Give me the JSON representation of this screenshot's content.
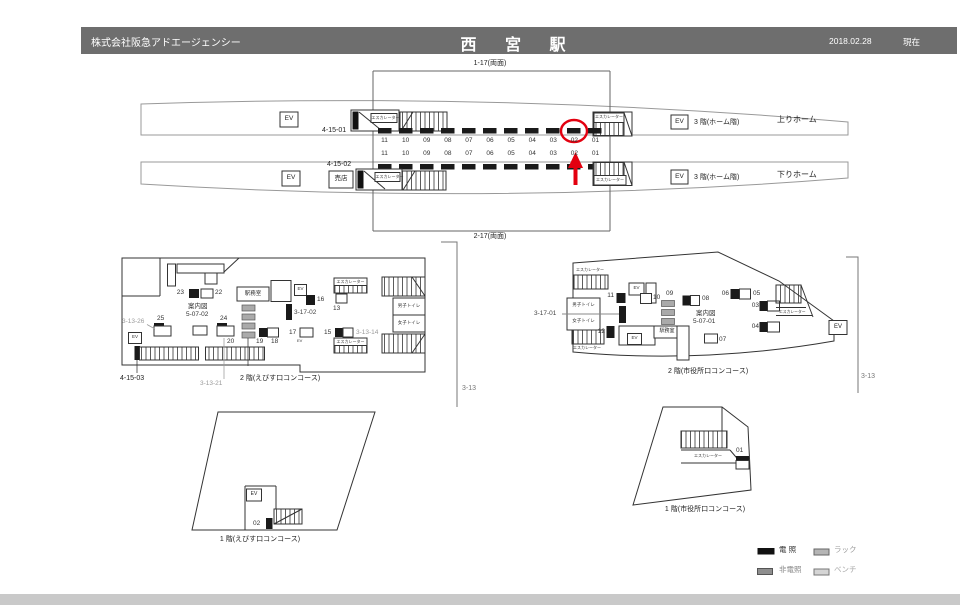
{
  "header": {
    "company": "株式会社阪急アドエージェンシー",
    "station": "西 宮 駅",
    "date": "2018.02.28",
    "as_of": "現在"
  },
  "labels": {
    "ev": "EV",
    "escalator": "エスカレーター"
  },
  "platforms": {
    "bracket_top": "1-17(両面)",
    "bracket_bottom": "2-17(両面)",
    "numbers": [
      "11",
      "10",
      "09",
      "08",
      "07",
      "06",
      "05",
      "04",
      "03",
      "02",
      "01"
    ],
    "up": {
      "esc_id": "4-15-01",
      "floor": "3 階(ホーム階)",
      "name": "上りホーム"
    },
    "down": {
      "esc_id": "4-15-02",
      "shop": "売店",
      "floor": "3 階(ホーム階)",
      "name": "下りホーム"
    }
  },
  "ebisu2f": {
    "title": "2 階(えびす口コンコース)",
    "office": "駅務室",
    "map": "案内図",
    "map_id": "5-07-02",
    "men": "男子トイレ",
    "women": "女子トイレ",
    "side": "3-13",
    "pos": {
      "13": "13",
      "15": "15",
      "16": "16",
      "17": "17",
      "18": "18",
      "19": "19",
      "20": "20",
      "22": "22",
      "23": "23",
      "24": "24",
      "25": "25"
    },
    "refs": {
      "r3_13_26": "3-13-26",
      "r3_13_21": "3-13-21",
      "r4_15_03": "4-15-03",
      "r3_17_02": "3-17-02",
      "r3_13_14": "3-13-14"
    }
  },
  "ebisu1f": {
    "title": "1 階(えびす口コンコース)",
    "pos02": "02"
  },
  "shiyakusho2f": {
    "title": "2 階(市役所口コンコース)",
    "office": "駅務室",
    "map": "案内図",
    "map_id": "5-07-01",
    "men": "男子トイレ",
    "women": "女子トイレ",
    "side": "3-13",
    "ref": "3-17-01",
    "pos": {
      "03": "03",
      "04": "04",
      "05": "05",
      "06": "06",
      "07": "07",
      "08": "08",
      "09": "09",
      "10": "10",
      "11": "11",
      "12": "12"
    }
  },
  "shiyakusho1f": {
    "title": "1 階(市役所口コンコース)",
    "pos01": "01"
  },
  "legend": {
    "illuminated": "電 照",
    "rack": "ラック",
    "non_illuminated": "非電照",
    "bench": "ベンチ"
  }
}
